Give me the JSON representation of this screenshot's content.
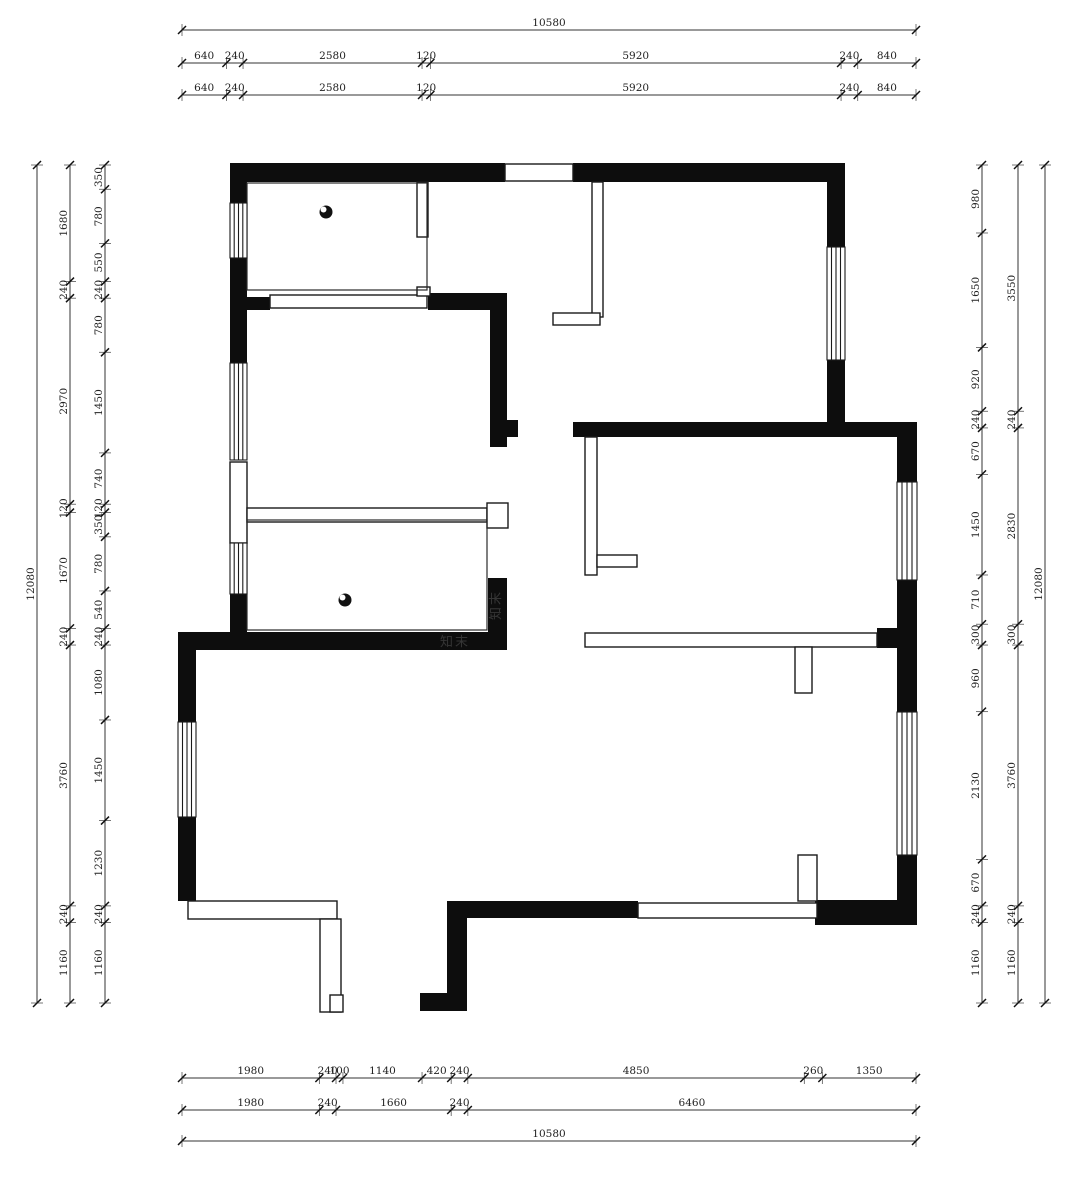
{
  "document": {
    "type": "floor-plan-drawing",
    "unit": "mm"
  },
  "watermark": {
    "text": "知末"
  },
  "dimensions": {
    "total_width": 10580,
    "total_height": 12080,
    "top": [
      {
        "name": "top-overall",
        "segments": [
          10580
        ]
      },
      {
        "name": "top-detail-1",
        "segments": [
          640,
          240,
          2580,
          120,
          5920,
          240,
          840
        ]
      },
      {
        "name": "top-detail-2",
        "segments": [
          640,
          240,
          2580,
          120,
          5920,
          240,
          840
        ]
      }
    ],
    "bottom": [
      {
        "name": "bottom-detail-1",
        "segments": [
          1980,
          240,
          100,
          1140,
          420,
          240,
          4850,
          260,
          1350
        ]
      },
      {
        "name": "bottom-detail-2",
        "segments": [
          1980,
          240,
          1660,
          240,
          6460
        ]
      },
      {
        "name": "bottom-overall",
        "segments": [
          10580
        ]
      }
    ],
    "left": [
      {
        "name": "left-overall",
        "segments": [
          12080
        ]
      },
      {
        "name": "left-detail-1",
        "segments": [
          1680,
          240,
          2970,
          120,
          1670,
          240,
          3760,
          240,
          1160
        ]
      },
      {
        "name": "left-detail-2",
        "segments": [
          350,
          780,
          550,
          240,
          780,
          1450,
          740,
          120,
          350,
          780,
          540,
          240,
          1080,
          1450,
          1230,
          240,
          1160
        ]
      }
    ],
    "right": [
      {
        "name": "right-detail-1",
        "segments": [
          980,
          1650,
          920,
          240,
          670,
          1450,
          710,
          300,
          960,
          2130,
          670,
          240,
          1160
        ]
      },
      {
        "name": "right-detail-2",
        "segments": [
          3550,
          240,
          2830,
          300,
          3760,
          240,
          1160
        ]
      },
      {
        "name": "right-overall",
        "segments": [
          12080
        ]
      }
    ]
  }
}
